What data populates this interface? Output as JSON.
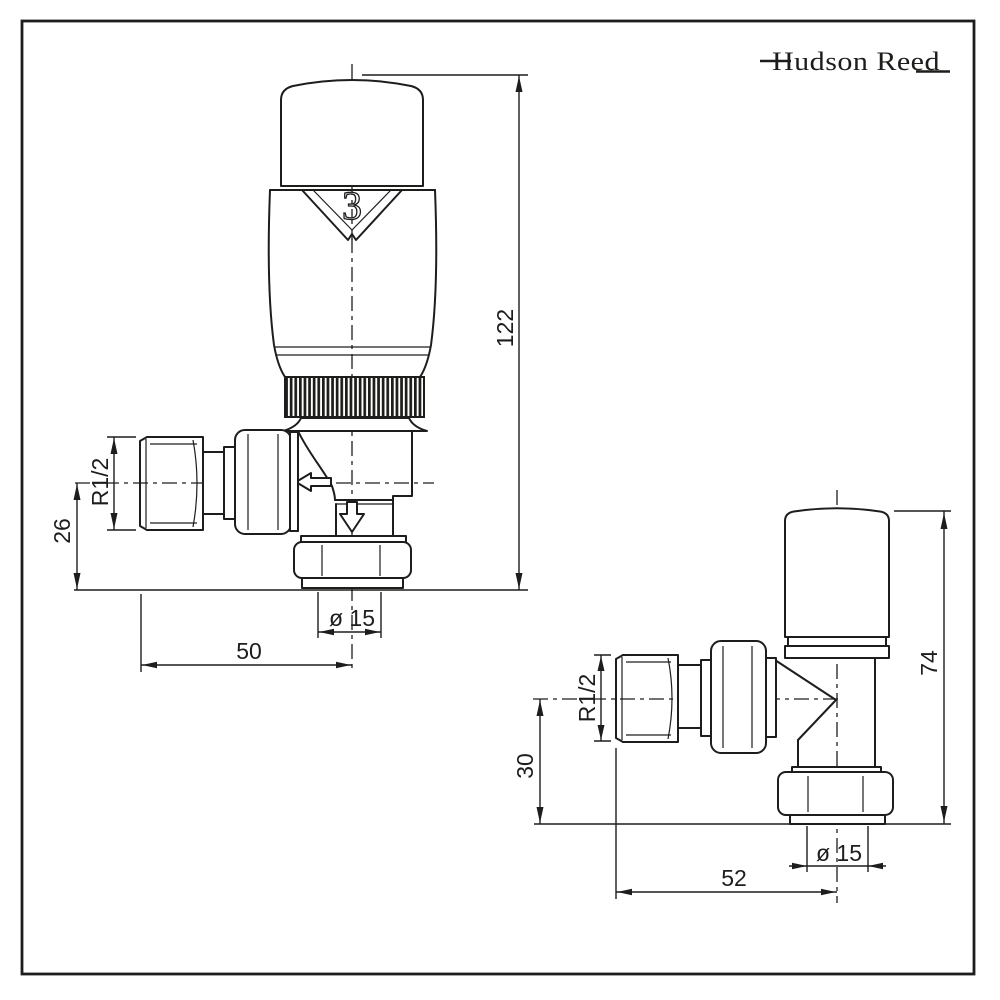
{
  "page": {
    "background": "#ffffff",
    "line_color": "#1d1d1b"
  },
  "brand": {
    "logo_text": "Hudson Reed"
  },
  "left_valve": {
    "head_setting": "3",
    "dimensions": {
      "overall_height": "122",
      "centre_to_baseline": "26",
      "tail_thread": "R1/2",
      "centre_to_tail_face": "50",
      "pipe_diameter": "ø 15"
    }
  },
  "right_valve": {
    "dimensions": {
      "overall_height": "74",
      "centre_to_baseline": "30",
      "tail_thread": "R1/2",
      "centre_to_tail_face": "52",
      "pipe_diameter": "ø 15"
    }
  }
}
